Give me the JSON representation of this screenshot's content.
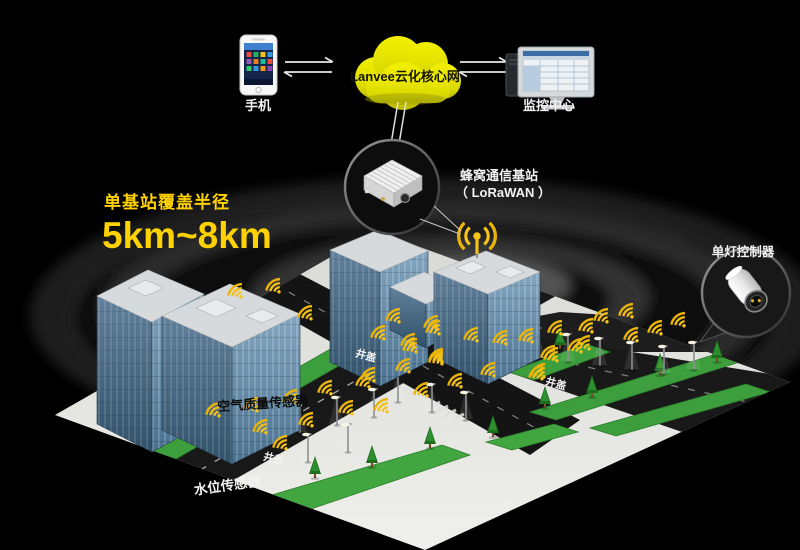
{
  "colors": {
    "background": "#000000",
    "accent_yellow": "#ffd200",
    "icon_yellow": "#f6c31a",
    "cloud_yellow": "#e8e600",
    "grass_green": "#3c9e3c",
    "building_blue": "#6d92ac",
    "road_dark": "#161616",
    "ground_light": "#e4e5e1"
  },
  "top": {
    "phone_label": "手机",
    "cloud_label": "Lanvee云化核心网",
    "monitor_label": "监控中心"
  },
  "basestation": {
    "line1": "蜂窝通信基站",
    "line2": "（ LoRaWAN ）"
  },
  "coverage": {
    "caption": "单基站覆盖半径",
    "range": "5km~8km"
  },
  "lamp_controller": {
    "label": "单灯控制器"
  },
  "city": {
    "air_quality_label": "空气质量传感器",
    "water_level_label": "水位传感器",
    "manhole_label": "井盖",
    "wifi_icons": [
      [
        242,
        298
      ],
      [
        280,
        293
      ],
      [
        312,
        320
      ],
      [
        220,
        417
      ],
      [
        258,
        412
      ],
      [
        297,
        404
      ],
      [
        332,
        395
      ],
      [
        370,
        388
      ],
      [
        267,
        434
      ],
      [
        287,
        450
      ],
      [
        313,
        427
      ],
      [
        353,
        415
      ],
      [
        388,
        413
      ],
      [
        400,
        323
      ],
      [
        438,
        330
      ],
      [
        385,
        340
      ],
      [
        417,
        353
      ],
      [
        443,
        365
      ],
      [
        410,
        373
      ],
      [
        375,
        382
      ],
      [
        428,
        397
      ],
      [
        440,
        335
      ],
      [
        478,
        342
      ],
      [
        507,
        345
      ],
      [
        533,
        343
      ],
      [
        562,
        335
      ],
      [
        593,
        333
      ],
      [
        415,
        348
      ],
      [
        443,
        363
      ],
      [
        558,
        362
      ],
      [
        590,
        350
      ],
      [
        495,
        377
      ],
      [
        543,
        380
      ],
      [
        462,
        388
      ],
      [
        608,
        323
      ],
      [
        633,
        318
      ],
      [
        662,
        335
      ],
      [
        685,
        327
      ],
      [
        638,
        342
      ],
      [
        555,
        360
      ],
      [
        545,
        378
      ],
      [
        582,
        353
      ]
    ],
    "lamps": [
      [
        224,
        447
      ],
      [
        262,
        440
      ],
      [
        300,
        433
      ],
      [
        337,
        425
      ],
      [
        374,
        417
      ],
      [
        568,
        362
      ],
      [
        600,
        366
      ],
      [
        632,
        370
      ],
      [
        664,
        374
      ],
      [
        694,
        370
      ],
      [
        398,
        402
      ],
      [
        432,
        412
      ],
      [
        466,
        420
      ],
      [
        308,
        462
      ],
      [
        348,
        452
      ],
      [
        508,
        368
      ],
      [
        538,
        356
      ]
    ],
    "trees": [
      [
        197,
        437
      ],
      [
        228,
        428
      ],
      [
        258,
        420
      ],
      [
        315,
        478
      ],
      [
        372,
        467
      ],
      [
        430,
        448
      ],
      [
        493,
        437
      ],
      [
        545,
        408
      ],
      [
        592,
        397
      ],
      [
        660,
        375
      ],
      [
        717,
        362
      ],
      [
        530,
        356
      ],
      [
        560,
        349
      ]
    ]
  }
}
